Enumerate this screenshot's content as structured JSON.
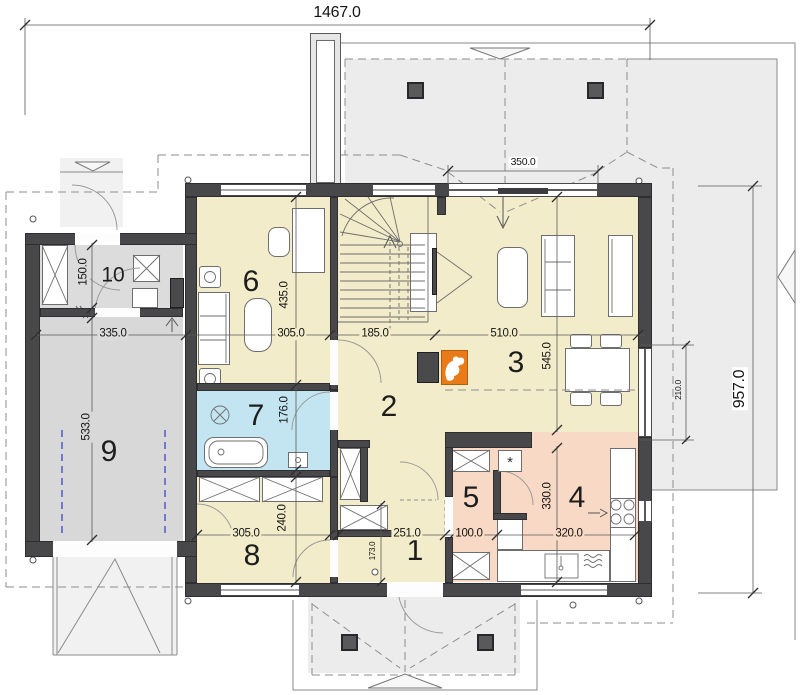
{
  "plan": {
    "rooms": [
      {
        "number": "1",
        "x": 415,
        "y": 551,
        "size": 30
      },
      {
        "number": "2",
        "x": 389,
        "y": 407,
        "size": 30
      },
      {
        "number": "3",
        "x": 516,
        "y": 363,
        "size": 30
      },
      {
        "number": "4",
        "x": 577,
        "y": 498,
        "size": 30
      },
      {
        "number": "5",
        "x": 471,
        "y": 498,
        "size": 30
      },
      {
        "number": "6",
        "x": 251,
        "y": 282,
        "size": 30
      },
      {
        "number": "7",
        "x": 256,
        "y": 416,
        "size": 30
      },
      {
        "number": "8",
        "x": 252,
        "y": 556,
        "size": 30
      },
      {
        "number": "9",
        "x": 109,
        "y": 452,
        "size": 30
      },
      {
        "number": "10",
        "x": 113,
        "y": 275,
        "size": 21
      }
    ],
    "dimensions": [
      {
        "text": "1467.0",
        "x": 337,
        "y": 13,
        "rot": 0,
        "size": 16,
        "bg": "#ffffff"
      },
      {
        "text": "957.0",
        "x": 740,
        "y": 389,
        "rot": -90,
        "size": 16,
        "bg": "#ffffff"
      },
      {
        "text": "350.0",
        "x": 523,
        "y": 162,
        "rot": 0,
        "size": 10.5,
        "bg": "#ffffff"
      },
      {
        "text": "335.0",
        "x": 113,
        "y": 334,
        "rot": 0,
        "size": 11.5,
        "bg": "#dcdcdc"
      },
      {
        "text": "150.0",
        "x": 84,
        "y": 272,
        "rot": -90,
        "size": 11.5,
        "bg": "#dcdcdc"
      },
      {
        "text": "533.0",
        "x": 87,
        "y": 427,
        "rot": -90,
        "size": 11.5,
        "bg": "#d8d8d8"
      },
      {
        "text": "305.0",
        "x": 291,
        "y": 334,
        "rot": 0,
        "size": 11.5,
        "bg": "#f3ecca"
      },
      {
        "text": "435.0",
        "x": 285,
        "y": 295,
        "rot": -90,
        "size": 11.5,
        "bg": "#f3ecca"
      },
      {
        "text": "185.0",
        "x": 375,
        "y": 334,
        "rot": 0,
        "size": 11.5,
        "bg": "#f3ecca"
      },
      {
        "text": "510.0",
        "x": 504,
        "y": 334,
        "rot": 0,
        "size": 11.5,
        "bg": "#f3ecca"
      },
      {
        "text": "545.0",
        "x": 548,
        "y": 356,
        "rot": -90,
        "size": 11.5,
        "bg": "#f3ecca"
      },
      {
        "text": "176.0",
        "x": 285,
        "y": 410,
        "rot": -90,
        "size": 11.5,
        "bg": "#c3e5f1"
      },
      {
        "text": "305.0",
        "x": 246,
        "y": 534,
        "rot": 0,
        "size": 11.5,
        "bg": "#f3ecca"
      },
      {
        "text": "240.0",
        "x": 283,
        "y": 518,
        "rot": -90,
        "size": 11.5,
        "bg": "#f3ecca"
      },
      {
        "text": "251.0",
        "x": 407,
        "y": 534,
        "rot": 0,
        "size": 11.5,
        "bg": "#f3ecca"
      },
      {
        "text": "173.0",
        "x": 373,
        "y": 551,
        "rot": -90,
        "size": 8,
        "bg": "#f3ecca"
      },
      {
        "text": "100.0",
        "x": 469,
        "y": 534,
        "rot": 0,
        "size": 11.5,
        "bg": "#f8d9c5"
      },
      {
        "text": "320.0",
        "x": 569,
        "y": 534,
        "rot": 0,
        "size": 11.5,
        "bg": "#f8d9c5"
      },
      {
        "text": "330.0",
        "x": 548,
        "y": 496,
        "rot": -90,
        "size": 11.5,
        "bg": "#f8d9c5"
      },
      {
        "text": "210.0",
        "x": 678,
        "y": 390,
        "rot": -90,
        "size": 8.5,
        "bg": "#ececec"
      }
    ],
    "symbols": {
      "washer_star": "*"
    },
    "colors": {
      "wall": "#48484b",
      "floor_cream": "#f3ecca",
      "floor_blue": "#c3e5f1",
      "floor_pink": "#f8d9c5",
      "floor_gray_light": "#dcdcdc",
      "floor_gray": "#d8d8d8",
      "terrace": "#ececec",
      "driveway": "#f1f1f1",
      "accent_orange": "#e87a18",
      "dash_gray": "#8e8e8e",
      "guide_blue": "#4553cc"
    }
  }
}
